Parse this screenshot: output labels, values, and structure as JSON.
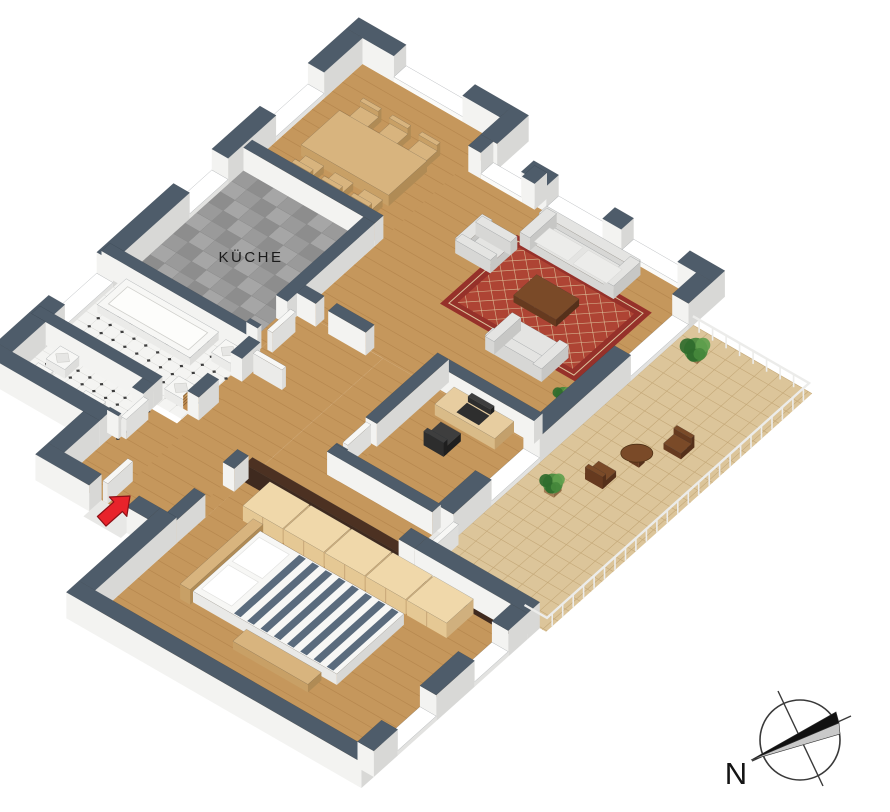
{
  "page": {
    "background": "#ffffff",
    "description": "3D isometric apartment floor plan rendering"
  },
  "labels": {
    "kitchen_room": "KÜCHE",
    "compass_north": "N"
  },
  "icons": {
    "entrance": "entrance-arrow",
    "orientation": "compass-rose"
  },
  "colors": {
    "wall_cap": "#4e5c6a",
    "wall_face_south": "#f3f3f1",
    "wall_face_east": "#d8d8d6",
    "wood_floor": "#c5975c",
    "wood_plank": "#8a5a28",
    "kitchen_tile_a": "#9a9a9a",
    "kitchen_tile_b": "#8d8d8d",
    "kitchen_tile_c": "#a6a6a6",
    "bath_tile": "#f4f4f2",
    "tile_line": "#d9d9d5",
    "tile_dot": "#3e3e3e",
    "balcony_tile": "#dcc59a",
    "balcony_line": "#c4a878",
    "rug_outer": "#96312a",
    "rug_inner": "#ae4434",
    "rug_accent": "#dcc39c",
    "sofa_top": "#e4e4e2",
    "sofa_face": "#c7c7c5",
    "sofa_side": "#d7d7d5",
    "wood_top": "#d8b47e",
    "wood_face": "#b08b55",
    "wood_side": "#c8a066",
    "dark_top": "#7a4a28",
    "dark_face": "#55301a",
    "dark_side": "#663a1f",
    "white_top": "#f7f7f5",
    "white_face": "#dddddb",
    "white_side": "#ebebe9",
    "black_top": "#3e3e3e",
    "black_face": "#1f1f1f",
    "black_side": "#2d2d2d",
    "wardrobe_top": "#f0d8aa",
    "wardrobe_face": "#d0b07e",
    "wardrobe_side": "#e5c894",
    "partition_top": "#4c3122",
    "partition_face": "#33211a",
    "partition_side": "#3f2a1f",
    "bed_stripe": "#5a6b7d",
    "bed_white": "#f7f7f5",
    "plant_dark": "#2f6b2c",
    "plant_mid": "#45883c",
    "plant_light": "#5fa04d",
    "railing": "#ececea",
    "arrow_red": "#e8232b",
    "arrow_edge": "#8c1016",
    "ink": "#1c1c1c"
  }
}
